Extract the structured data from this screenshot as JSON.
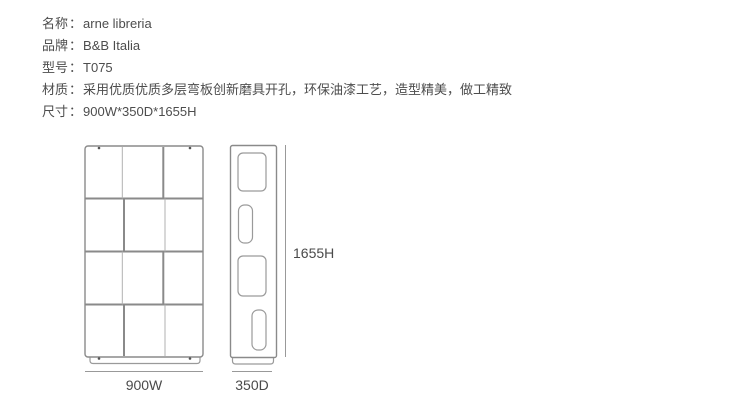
{
  "product": {
    "separator": "：",
    "specs": [
      {
        "label": "名称",
        "value": "arne libreria"
      },
      {
        "label": "品牌",
        "value": "B&B Italia"
      },
      {
        "label": "型号",
        "value": "T075"
      },
      {
        "label": "材质",
        "value": "采用优质优质多层弯板创新磨具开孔，环保油漆工艺，造型精美，做工精致"
      },
      {
        "label": "尺寸",
        "value": "900W*350D*1655H"
      }
    ]
  },
  "diagram": {
    "width_label": "900W",
    "depth_label": "350D",
    "height_label": "1655H"
  },
  "colors": {
    "text": "#4d4d4d",
    "line_strong": "#8a8a8a",
    "line_light": "#b0b0b0",
    "dimension_line": "#999999"
  }
}
